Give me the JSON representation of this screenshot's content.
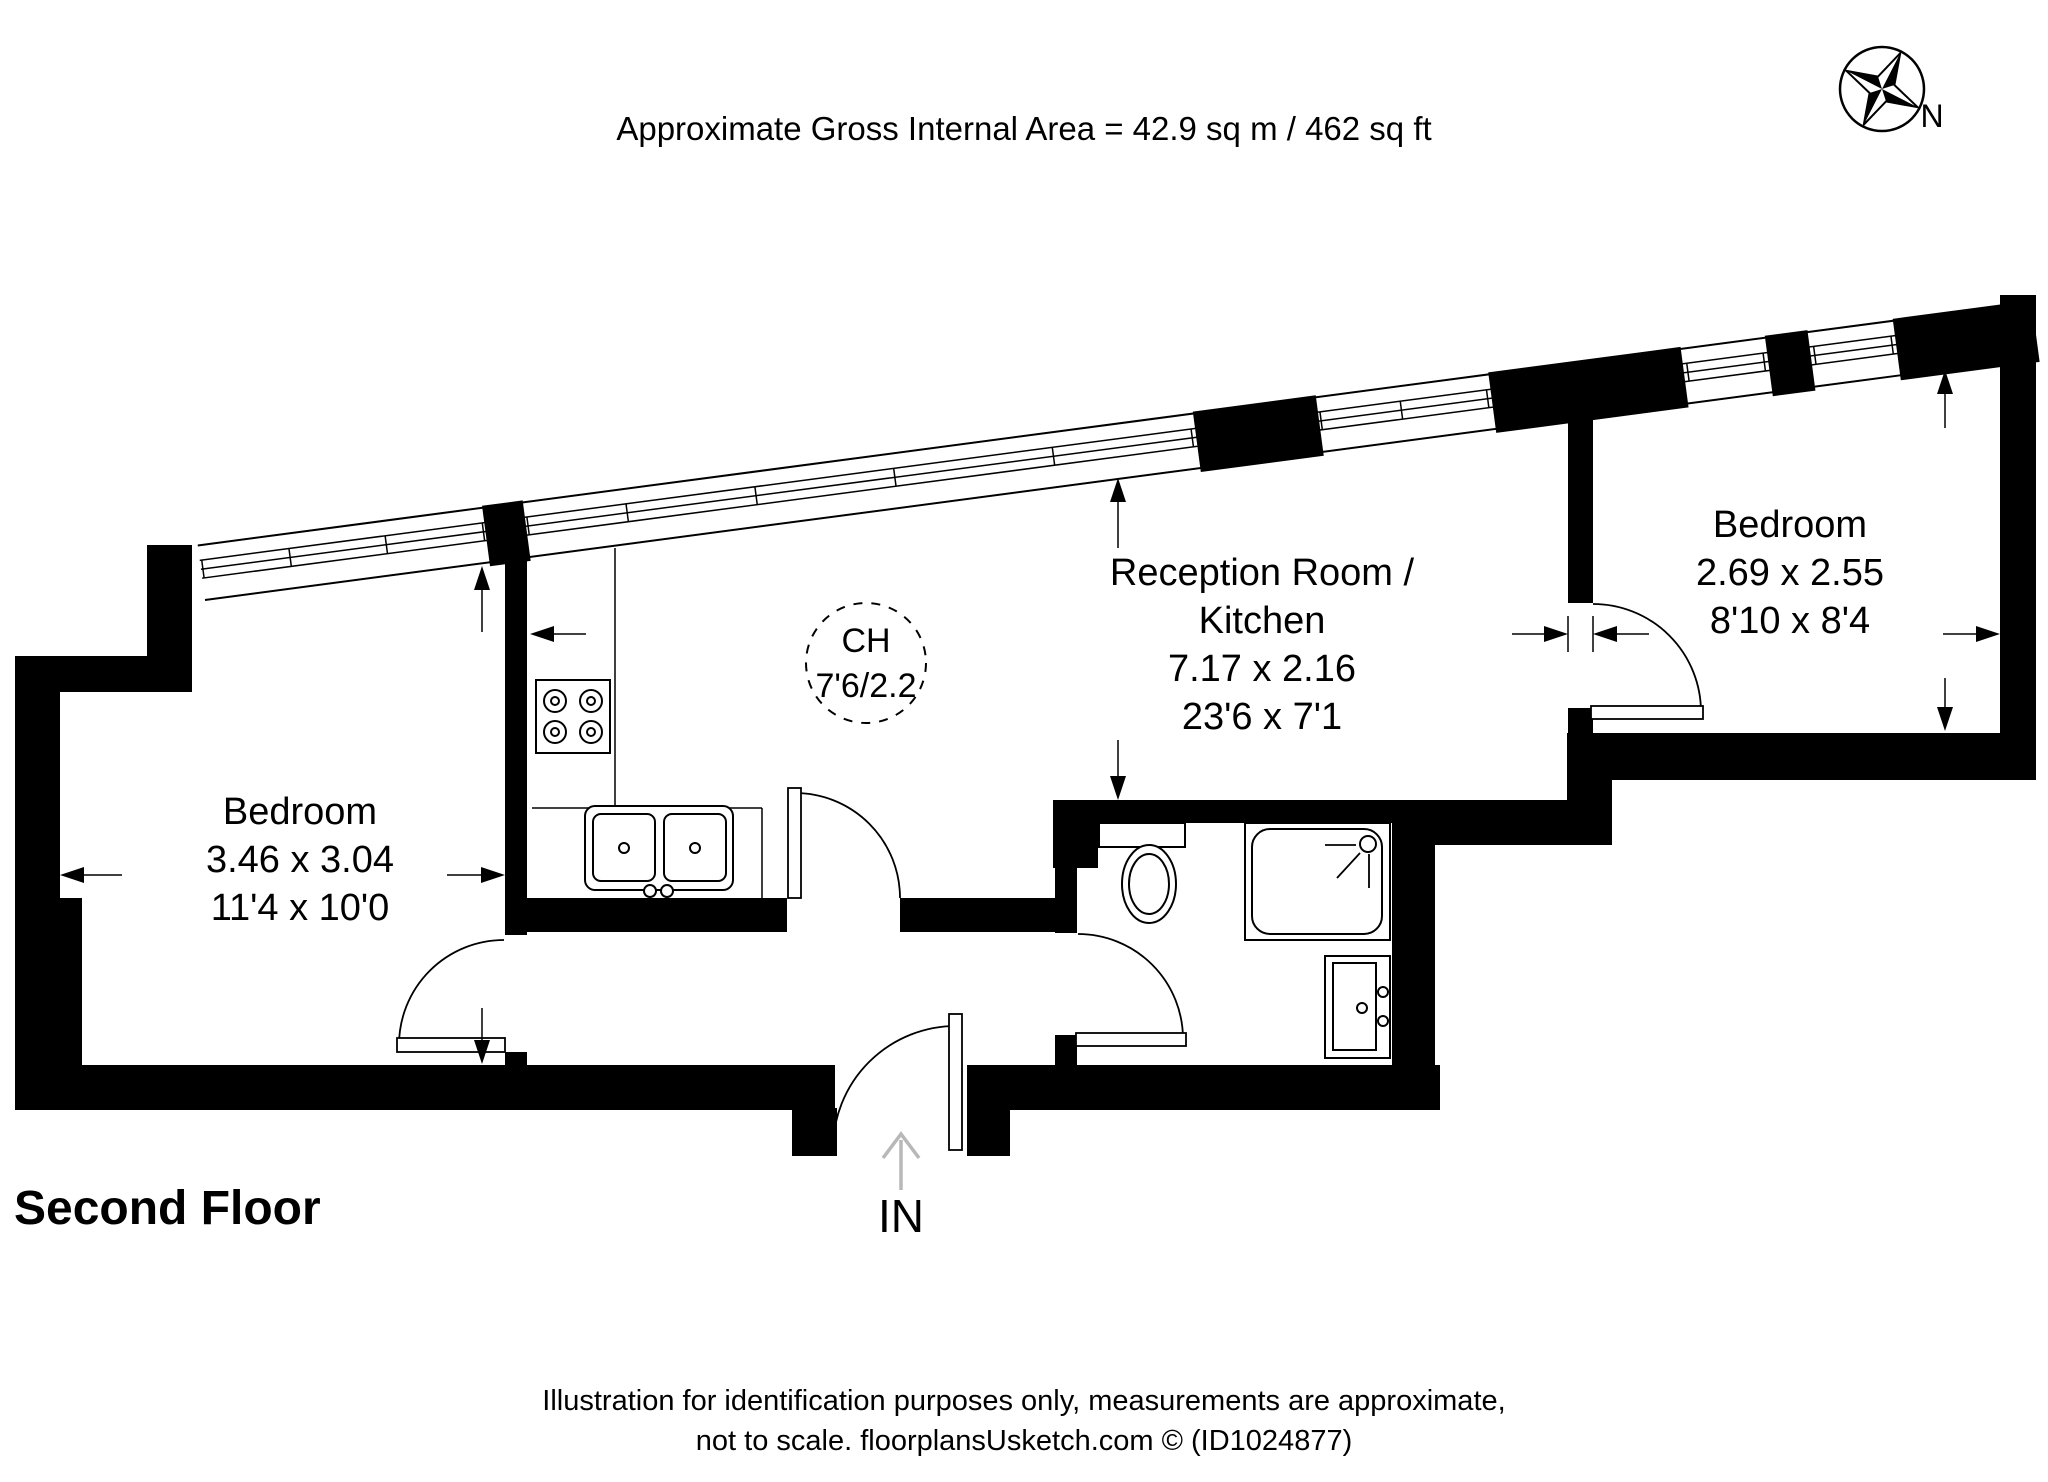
{
  "title": {
    "area_note": "Approximate Gross Internal Area = 42.9 sq m / 462 sq ft"
  },
  "compass": {
    "north_label": "N"
  },
  "rooms": {
    "bedroom_left": {
      "name": "Bedroom",
      "size_metric": "3.46 x 3.04",
      "size_imperial": "11'4 x 10'0"
    },
    "reception_kitchen": {
      "name_line1": "Reception Room /",
      "name_line2": "Kitchen",
      "size_metric": "7.17 x 2.16",
      "size_imperial": "23'6 x 7'1"
    },
    "bedroom_right": {
      "name": "Bedroom",
      "size_metric": "2.69 x 2.55",
      "size_imperial": "8'10 x 8'4"
    }
  },
  "ceiling_height": {
    "abbr": "CH",
    "value": "7'6/2.2"
  },
  "entrance": {
    "label": "IN"
  },
  "floor_label": "Second Floor",
  "footer": {
    "line1": "Illustration for identification purposes only, measurements are approximate,",
    "line2": "not to scale. floorplansUsketch.com © (ID1024877)"
  },
  "colors": {
    "wall": "#000000",
    "background": "#ffffff",
    "entry_arrow": "#b8b8b8"
  }
}
